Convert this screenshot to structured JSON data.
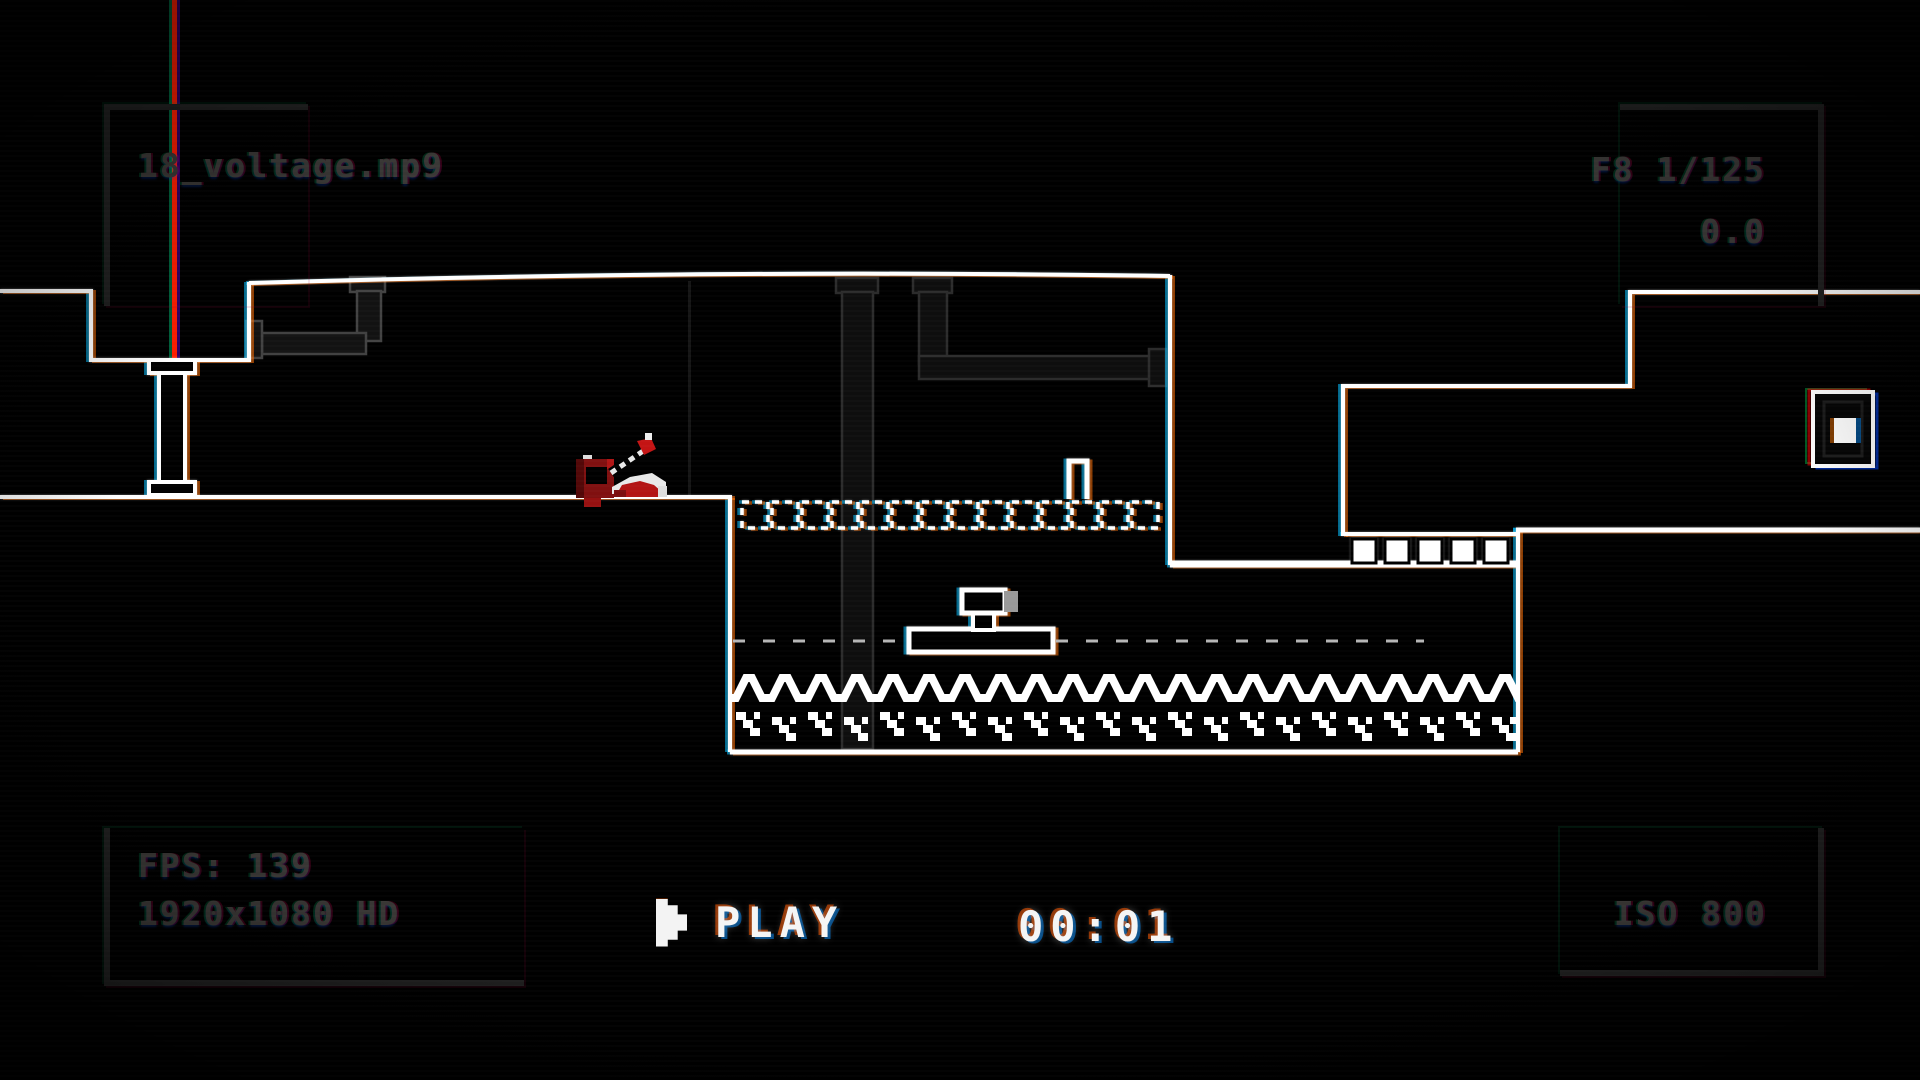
{
  "hud": {
    "filename": "18_voltage.mp9",
    "camera_settings": "F8 1/125",
    "exposure_value": "0.0",
    "fps_counter": "FPS: 139",
    "resolution_label": "1920x1080 HD",
    "iso_label": "ISO 800",
    "play_label": "PLAY",
    "timecode": "00:01",
    "icons": {
      "play_icon": "pixel-play-triangle",
      "frame_brackets": "viewfinder-corner-brackets"
    }
  },
  "game": {
    "icons": {
      "exit_door_icon": "glowing-door",
      "hazard_icon": "electrified-water-waves",
      "character_icon": "red-pixel-contraption",
      "platform_icon": "moving-platform-with-button",
      "blocks_icon": "dashed-outline-blocks",
      "pipes_icon": "background-pipes",
      "laser_icon": "red-vertical-beam"
    }
  },
  "colors": {
    "background": "#000000",
    "terrain_outline": "#ffffff",
    "hud_dim_text": "#3a3836",
    "hud_bright_text": "#f5f5f5",
    "laser_red": "#ff1e00",
    "character_red": "#9c1212",
    "pipe_gray": "#2e2e2e",
    "platform_shadow_gray": "#999999",
    "aberration_warm": "#ff6e00",
    "aberration_cool": "#00beff"
  }
}
